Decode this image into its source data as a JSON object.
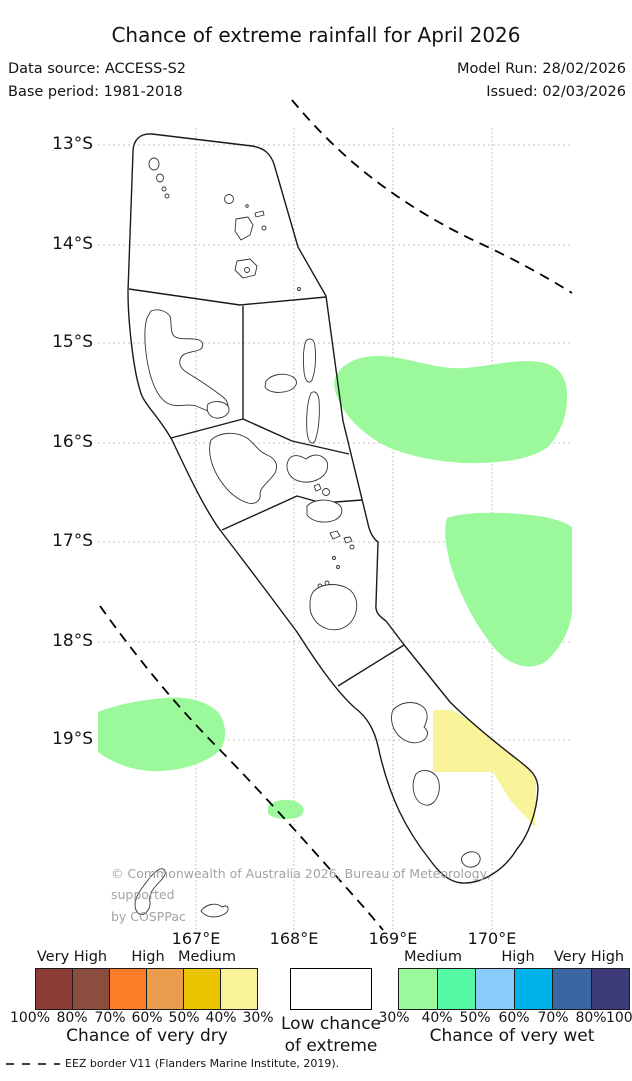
{
  "title": "Chance of extreme rainfall for April 2026",
  "header": {
    "data_source": "Data source: ACCESS-S2",
    "base_period": "Base period: 1981-2018",
    "model_run": "Model Run: 28/02/2026",
    "issued": "Issued: 02/03/2026"
  },
  "map": {
    "lat_labels": [
      "13°S",
      "14°S",
      "15°S",
      "16°S",
      "17°S",
      "18°S",
      "19°S"
    ],
    "lon_labels": [
      "167°E",
      "168°E",
      "169°E",
      "170°E"
    ],
    "colors": {
      "wet_patch": "#9bf99b",
      "dry_patch": "#f9f39a"
    },
    "copyright_line1": "© Commonwealth of Australia 2026, Bureau of Meteorology, supported",
    "copyright_line2": "by COSPPac"
  },
  "legend": {
    "dry": {
      "headers": [
        "Very High",
        "High",
        "Medium"
      ],
      "colors": [
        "#8b3b33",
        "#8a4d3e",
        "#fc7e29",
        "#eb9c4d",
        "#eac400",
        "#f9f397"
      ],
      "percent_labels": [
        "100%",
        "80%",
        "70%",
        "60%",
        "50%",
        "40%",
        "30%"
      ],
      "title": "Chance of very dry"
    },
    "low": {
      "line1": "Low chance",
      "line2": "of extreme"
    },
    "wet": {
      "headers": [
        "Medium",
        "High",
        "Very High"
      ],
      "colors": [
        "#9bf99b",
        "#55f8a4",
        "#88ccfa",
        "#00b2ea",
        "#3a67a1",
        "#3d3c78"
      ],
      "percent_labels": [
        "30%",
        "40%",
        "50%",
        "60%",
        "70%",
        "80%",
        "100%"
      ],
      "title": "Chance of very wet"
    }
  },
  "footer": {
    "eez_note": "EEZ border V11 (Flanders Marine Institute, 2019)."
  }
}
